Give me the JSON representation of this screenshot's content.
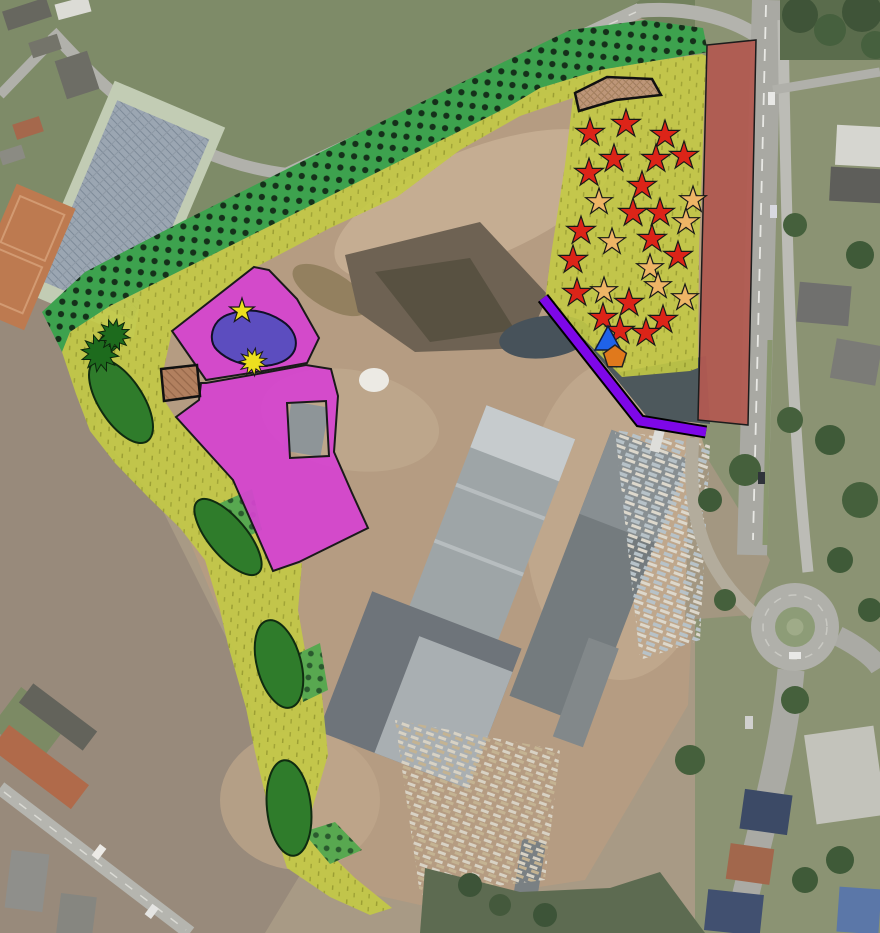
{
  "map": {
    "colors": {
      "band_green": "#3da24e",
      "band_dot": "#15301a",
      "zone_yellow": "#c3ca45",
      "zone_magenta": "#d544d0",
      "strip_red": "#b15a51",
      "pond_blue": "#4b4dbd",
      "line_purple": "#7e07e8",
      "ellipse_green": "#2f7c2b",
      "patch_green": "#58a850",
      "tree_green": "#1d6b1d",
      "star_red": "#dc2418",
      "star_orange": "#eeb566",
      "star_yellow": "#ecdf1f",
      "triangle_blue": "#1f62e8",
      "pentagon_orange": "#e0791c",
      "tan_fill": "#b2805f",
      "tan_fill_light": "#bd9678"
    },
    "hedgerow_band": {
      "points": "42,312 85,272 185,220 285,170 385,120 487,70 570,30 645,20 703,28 708,52 660,60 600,70 540,88 510,106 410,156 310,206 210,256 110,306 70,332 62,352"
    },
    "landscape_zone": {
      "points": "62,352 70,332 110,306 210,256 310,206 410,156 510,106 540,88 600,70 660,60 702,54 706,56 699,250 698,368 690,371 622,377 545,300 551,255 565,165 573,98 520,116 460,150 397,197 330,228 256,267 172,331 163,372 164,400 175,417 233,480 273,571 302,563 298,610 305,650 322,695 328,755 306,830 355,878 392,908 370,915 330,897 287,868 270,815 255,752 246,708 228,645 220,610 205,560 180,528 148,497 115,463 90,431 76,394"
    },
    "reserve_strip": {
      "points": "707,45 756,40 748,425 698,420"
    },
    "zone_upper": {
      "path": "M172,331 L254,267 L269,270 L297,299 L319,338 L307,363 L263,371 L206,380 Z"
    },
    "zone_lower": {
      "path": "M206,383 L263,373 L306,365 L331,369 L338,396 L334,452 L352,493 L368,528 L299,562 L273,571 L233,480 L176,417 L199,400 L201,383 Z M287,403 L326,401 L329,456 L290,458 Z"
    },
    "pond": {
      "path": "M230,314 C248,307 267,311 282,321 C293,328 298,339 295,349 C291,360 277,366 260,366 C243,366 227,360 217,350 C209,342 211,329 218,321 C222,317 226,315 230,314 Z"
    },
    "tan_structures": [
      {
        "points": "161,369 197,365 200,396 164,401"
      },
      {
        "points": "575,93 607,77 652,79 661,95 616,100 579,111"
      }
    ],
    "planting_patches": [
      "216,505 252,489 262,530 226,546",
      "295,655 320,643 328,690 303,702",
      "303,832 335,822 362,850 330,864"
    ],
    "hedge_ellipses": [
      {
        "cx": 121,
        "cy": 401,
        "rx": 22,
        "ry": 48,
        "rot": -33
      },
      {
        "cx": 228,
        "cy": 537,
        "rx": 19,
        "ry": 47,
        "rot": -40
      },
      {
        "cx": 279,
        "cy": 664,
        "rx": 22,
        "ry": 45,
        "rot": -15
      },
      {
        "cx": 289,
        "cy": 808,
        "rx": 22,
        "ry": 48,
        "rot": -6
      }
    ],
    "tree_symbols": [
      {
        "x": 100,
        "y": 353,
        "r": 19
      },
      {
        "x": 114,
        "y": 335,
        "r": 16
      }
    ],
    "screen_line": {
      "points": "543,298 640,421 706,432"
    },
    "red_stars": [
      [
        590,
        133
      ],
      [
        626,
        124
      ],
      [
        665,
        135
      ],
      [
        614,
        159
      ],
      [
        656,
        159
      ],
      [
        684,
        156
      ],
      [
        589,
        173
      ],
      [
        642,
        186
      ],
      [
        633,
        213
      ],
      [
        660,
        213
      ],
      [
        581,
        231
      ],
      [
        652,
        239
      ],
      [
        573,
        260
      ],
      [
        678,
        256
      ],
      [
        577,
        293
      ],
      [
        629,
        303
      ],
      [
        603,
        318
      ],
      [
        663,
        320
      ],
      [
        620,
        331
      ],
      [
        646,
        333
      ]
    ],
    "orange_stars": [
      [
        599,
        202
      ],
      [
        693,
        200
      ],
      [
        686,
        222
      ],
      [
        612,
        242
      ],
      [
        650,
        268
      ],
      [
        604,
        291
      ],
      [
        658,
        286
      ],
      [
        685,
        298
      ]
    ],
    "yellow_star": {
      "x": 242,
      "y": 311
    },
    "yellow_burst": {
      "x": 253,
      "y": 362
    },
    "blue_triangle": {
      "points": "608,326 595,350 621,350"
    },
    "orange_pentagon": {
      "x": 615,
      "y": 357,
      "r": 12
    }
  }
}
